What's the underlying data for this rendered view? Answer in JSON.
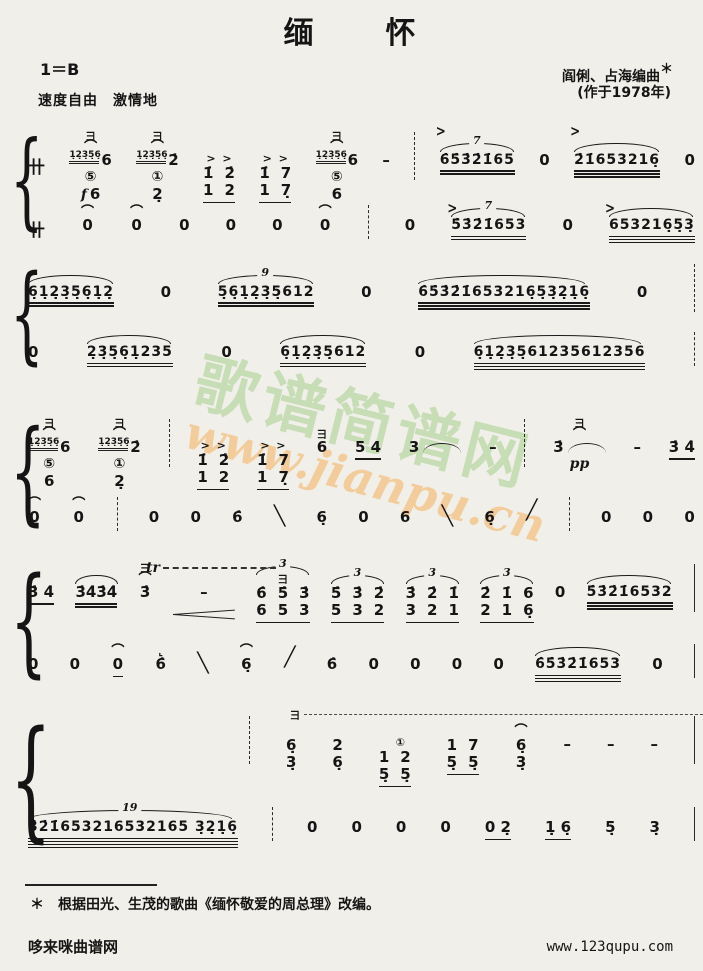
{
  "page": {
    "title": "缅　　怀",
    "key": "1＝B",
    "tempo": "速度自由　激情地",
    "composer": "阎俐、占海编曲",
    "composer_mark": "＊",
    "year": "(作于1978年)",
    "footnote_star": "＊",
    "footnote": "根据田光、生茂的歌曲《缅怀敬爱的周总理》改编。",
    "site_left": "哆来咪曲谱网",
    "site_right": "www.123qupu.com"
  },
  "watermark": {
    "cn": "歌谱简谱网",
    "url": "www.jianpu.cn",
    "color_cn": "#a4cd8c",
    "color_url": "#f3b66a"
  },
  "symbols": {
    "brace": "{",
    "meter": "卄",
    "yaozhi": "彐",
    "accent": ">",
    "fermata": "⌒",
    "hook": "⌞",
    "tr": "tr",
    "gliss_down": "╲",
    "gliss_up": "╱"
  },
  "systems": [
    {
      "top": 126,
      "h": 110,
      "upper": [
        {
          "sym": true
        },
        {
          "grace": "1̣2̣3̣5̣6̣",
          "top": [
            "彐",
            "⌒"
          ],
          "notes": "6",
          "circle": "⑤",
          "sub": "6",
          "dyn": "f"
        },
        {
          "grace": "1̣2̣3̣5̣6̣",
          "top": [
            "彐",
            "⌒"
          ],
          "notes": "2̇",
          "circle": "①",
          "sub": "2̣"
        },
        {
          "ctop": [
            ">",
            ">"
          ],
          "stack": [
            [
              "1̇",
              "1"
            ],
            [
              "2̇",
              "2"
            ]
          ],
          "u": 1
        },
        {
          "ctop": [
            ">",
            ">"
          ],
          "stack": [
            [
              "1̇",
              "1"
            ],
            [
              "7",
              "7̣"
            ]
          ],
          "u": 1
        },
        {
          "grace": "1̣2̣3̣5̣6̣",
          "top": [
            "彐",
            "⌒"
          ],
          "notes": "6",
          "circle": "⑤",
          "sub": "6"
        },
        {
          "notes": "–"
        },
        {
          "bar": "dashed"
        },
        {
          "accent": true,
          "tuplet": "7",
          "notes": "6̇5̇3̇2̇1̇65",
          "u": 2
        },
        {
          "notes": "0"
        },
        {
          "accent": true,
          "slur": true,
          "notes": "2̇1̇653216̣",
          "u": 3
        },
        {
          "notes": "0"
        }
      ],
      "lower": [
        {
          "sym": true
        },
        {
          "top": [
            "⌒"
          ],
          "notes": "0"
        },
        {
          "top": [
            "⌒"
          ],
          "notes": "0"
        },
        {
          "notes": "0"
        },
        {
          "notes": "0"
        },
        {
          "notes": "0"
        },
        {
          "top": [
            "⌒"
          ],
          "notes": "0"
        },
        {
          "bar": "dashed"
        },
        {
          "notes": "0"
        },
        {
          "accent": true,
          "tuplet": "7",
          "notes": "5̇3̇2̇1̇653",
          "u": 2
        },
        {
          "notes": "0"
        },
        {
          "accent": true,
          "slur": true,
          "notes": "653216̣5̣3̣",
          "u": 3
        }
      ]
    },
    {
      "top": 258,
      "h": 112,
      "upper": [
        {
          "slur": true,
          "notes": "6̣1̣2̣3̣5̣6̣1̣2̣",
          "u": 2
        },
        {
          "notes": "0"
        },
        {
          "tuplet": "9",
          "notes": "5̣6̣1̣2̣3̣5̣612",
          "u": 2
        },
        {
          "notes": "0"
        },
        {
          "slur": true,
          "notes": "6̇5̇3̇2̇1̇653216̣5̣3̣2̣1̣6̣",
          "u": 3
        },
        {
          "notes": "0"
        },
        {
          "bar": "dashed"
        }
      ],
      "lower": [
        {
          "notes": "0"
        },
        {
          "slur": true,
          "notes": "2̣3̣5̣6̣1̣235",
          "u": 2
        },
        {
          "notes": "0"
        },
        {
          "slur": true,
          "notes": "6̣1̣2̣3̣5̣612",
          "u": 2
        },
        {
          "notes": "0"
        },
        {
          "slur": true,
          "notes": "6̣1̣2̣3̣5̣61235612356",
          "u": 3
        },
        {
          "bar": "dashed"
        }
      ]
    },
    {
      "top": 413,
      "h": 118,
      "upper": [
        {
          "grace": "1̣2̣3̣5̣6̣",
          "top": [
            "彐",
            "⌒"
          ],
          "notes": "6",
          "circle": "⑤",
          "sub": "6"
        },
        {
          "grace": "1̣2̣3̣5̣6̣",
          "top": [
            "彐",
            "⌒"
          ],
          "notes": "2̇",
          "circle": "①",
          "sub": "2̣"
        },
        {
          "bar": "dashed"
        },
        {
          "ctop": [
            ">",
            ">"
          ],
          "stack": [
            [
              "1̇",
              "1"
            ],
            [
              "2̇",
              "2"
            ]
          ],
          "u": 1
        },
        {
          "ctop": [
            ">",
            ">"
          ],
          "stack": [
            [
              "1̇",
              "1"
            ],
            [
              "7",
              "7̣"
            ]
          ],
          "u": 1
        },
        {
          "top": [
            "彐"
          ],
          "notes": "6"
        },
        {
          "notes": "5 4",
          "u": 1
        },
        {
          "notes": "3",
          "tie": true
        },
        {
          "notes": "–"
        },
        {
          "bar": "dashed"
        },
        {
          "top": [
            "彐",
            "⌒"
          ],
          "notes": "3̇",
          "dyn": "pp",
          "tie": true
        },
        {
          "notes": "–"
        },
        {
          "notes": "3̇ 4̇",
          "u": 1
        }
      ],
      "lower": [
        {
          "top": [
            "⌒"
          ],
          "notes": "0"
        },
        {
          "top": [
            "⌒"
          ],
          "notes": "0"
        },
        {
          "bar": "dashed"
        },
        {
          "notes": "0"
        },
        {
          "notes": "0"
        },
        {
          "notes": "6̇"
        },
        {
          "gliss": "down"
        },
        {
          "notes": "6̣"
        },
        {
          "notes": "0"
        },
        {
          "notes": "6"
        },
        {
          "gliss": "down"
        },
        {
          "notes": "6̣"
        },
        {
          "gliss": "up"
        },
        {
          "bar": "dashed"
        },
        {
          "notes": "0"
        },
        {
          "notes": "0"
        },
        {
          "notes": "0"
        }
      ]
    },
    {
      "top": 558,
      "h": 124,
      "upper": [
        {
          "notes": "3̇ 4̇",
          "u": 1
        },
        {
          "slur": true,
          "notes": "3̇4̇3̇4̇",
          "u": 2
        },
        {
          "top": [
            "彐",
            "⌒"
          ],
          "notes": "3̇",
          "tr": true
        },
        {
          "notes": "–",
          "hairpin": true
        },
        {
          "tuplet": "3",
          "top": [
            "彐"
          ],
          "stack": [
            [
              "6̇",
              "6"
            ],
            [
              "5̇",
              "5"
            ],
            [
              "3̇",
              "3"
            ]
          ],
          "u": 1
        },
        {
          "tuplet": "3",
          "stack": [
            [
              "5̇",
              "5"
            ],
            [
              "3̇",
              "3"
            ],
            [
              "2̇",
              "2"
            ]
          ],
          "u": 1
        },
        {
          "tuplet": "3",
          "stack": [
            [
              "3̇",
              "3"
            ],
            [
              "2̇",
              "2"
            ],
            [
              "1̇",
              "1"
            ]
          ],
          "u": 1
        },
        {
          "tuplet": "3",
          "stack": [
            [
              "2̇",
              "2"
            ],
            [
              "1̇",
              "1"
            ],
            [
              "6",
              "6̣"
            ]
          ],
          "u": 1
        },
        {
          "notes": "0"
        },
        {
          "slur": true,
          "notes": "5̇3̇2̇1̇6532",
          "u": 3
        },
        {
          "bar": "solid"
        }
      ],
      "lower": [
        {
          "notes": "0"
        },
        {
          "notes": "0"
        },
        {
          "top": [
            "⌒"
          ],
          "notes": "0",
          "u": 1
        },
        {
          "top": [
            "⌞"
          ],
          "notes": "6̇"
        },
        {
          "gliss": "down"
        },
        {
          "top": [
            "⌒"
          ],
          "notes": "6̣"
        },
        {
          "gliss": "up"
        },
        {
          "notes": "6̇"
        },
        {
          "notes": "0"
        },
        {
          "notes": "0"
        },
        {
          "notes": "0"
        },
        {
          "notes": "0"
        },
        {
          "slur": true,
          "notes": "6̇5̇3̇2̇1̇653",
          "u": 3
        },
        {
          "notes": "0"
        },
        {
          "bar": "solid"
        }
      ]
    },
    {
      "top": 710,
      "h": 138,
      "upper": [
        {
          "gap": 185
        },
        {
          "bar": "dashed"
        },
        {
          "tremext": 445,
          "stack": [
            [
              "6̣",
              "3̣"
            ]
          ]
        },
        {
          "stack": [
            [
              "2",
              "6̣"
            ]
          ]
        },
        {
          "ctop": [
            "",
            "①"
          ],
          "stack": [
            [
              "1",
              "5̣"
            ],
            [
              "2",
              "5̣"
            ]
          ],
          "u": 1
        },
        {
          "stack": [
            [
              "1",
              "5̣"
            ],
            [
              "7",
              "5̣"
            ]
          ],
          "u": 1
        },
        {
          "top": [
            "⌒"
          ],
          "stack": [
            [
              "6̣",
              "3̣"
            ]
          ]
        },
        {
          "notes": "–"
        },
        {
          "notes": "–"
        },
        {
          "notes": "–"
        },
        {
          "bar": "solid"
        }
      ],
      "lower": [
        {
          "tuplet": "19",
          "notes": "3̇2̇1̇653216532165 3̣2̣1̣6̣",
          "u": 4
        },
        {
          "bar": "dashed"
        },
        {
          "notes": "0"
        },
        {
          "notes": "0"
        },
        {
          "notes": "0"
        },
        {
          "notes": "0"
        },
        {
          "notes": "0 2̣",
          "u": 1
        },
        {
          "notes": "1̣ 6̣",
          "u": 1
        },
        {
          "notes": "5̣"
        },
        {
          "notes": "3̣"
        },
        {
          "bar": "solid"
        }
      ]
    }
  ]
}
